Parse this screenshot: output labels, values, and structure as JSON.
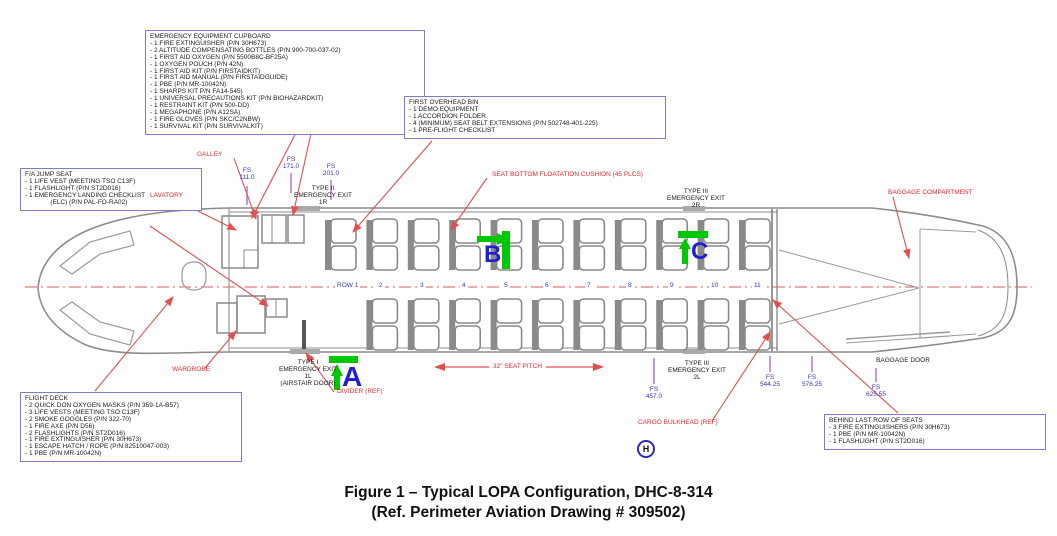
{
  "figure": {
    "caption_line1": "Figure 1 – Typical LOPA Configuration, DHC-8-314",
    "caption_line2": "(Ref. Perimeter Aviation Drawing # 309502)"
  },
  "callout_boxes": {
    "emergency_equipment_cupboard": {
      "title": "EMERGENCY EQUIPMENT CUPBOARD",
      "items": [
        "- 1 FIRE EXTINGUISHER (P/N 30H673)",
        "- 2 ALTITUDE COMPENSATING BOTTLES (P/N 900-700-037-02)",
        "- 1 FIRST AID OXYGEN (P/N 5500B8C-BF25A)",
        "- 1 OXYGEN POUCH (P/N 42N)",
        "- 1 FIRST AID KIT (P/N FIRSTAIDKIT)",
        "- 1 FIRST AID MANUAL (P/N FIRSTAIDGUIDE)",
        "- 1 PBE (P/N MR-10042N)",
        "- 1 SHARPS KIT P/N FA14-545)",
        "- 1 UNIVERSAL PRECAUTIONS KIT (P/N BIOHAZARDKIT)",
        "- 1 RESTRAINT KIT (P/N 500-DD)",
        "- 1 MEGAPHONE (P/N A12SA)",
        "- 1 FIRE GLOVES (P/N SKC/C2NBW)",
        "- 1 SURVIVAL KIT (P/N SURVIVALKIT)"
      ]
    },
    "fa_jump_seat": {
      "title": "F/A JUMP SEAT",
      "items": [
        "- 1 LIFE VEST (MEETING TSO C13F)",
        "- 1 FLASHLIGHT (P/N ST2D016)",
        "- 1 EMERGENCY LANDING CHECKLIST",
        "              (ELC) (P/N PAL-FO-RA02)"
      ]
    },
    "first_overhead_bin": {
      "title": "FIRST OVERHEAD BIN",
      "items": [
        "- 1 DEMO EQUIPMENT",
        "- 1 ACCORDION FOLDER",
        "- 4 (MINIMUM) SEAT BELT EXTENSIONS (P/N 502748-401-225)",
        "- 1 PRE-FLIGHT CHECKLIST"
      ]
    },
    "flight_deck": {
      "title": "FLIGHT DECK",
      "items": [
        "- 2 QUICK DON OXYGEN MASKS (P/N 359-1A-B57)",
        "- 3 LIFE VESTS (MEETING TSO C13F)",
        "- 2 SMOKE GOGGLES (P/N 322-70)",
        "- 1 FIRE AXE (P/N D56)",
        "- 2 FLASHLIGHTS (P/N ST2D016)",
        "- 1 FIRE EXTINGUISHER (P/N 30H673)",
        "- 1 ESCAPE HATCH / ROPE (P/N 82510047-003)",
        "- 1 PBE (P/N MR-10042N)"
      ]
    },
    "behind_last_row": {
      "title": "BEHIND LAST ROW OF SEATS",
      "items": [
        "- 3 FIRE EXTINGUISHERS (P/N 30H673)",
        "- 1 PBE (P/N MR-10042N)",
        "- 1 FLASHLIGHT (P/N ST2D016)"
      ]
    }
  },
  "red_labels": {
    "galley": "GALLEY",
    "lavatory": "LAVATORY",
    "seat_cushion": "SEAT BOTTOM FLOATATION CUSHION (45 PLCS)",
    "baggage_compartment": "BAGGAGE COMPARTMENT",
    "wardrobe": "WARDROBE",
    "divider_ref": "DIVIDER (REF)",
    "cargo_bulkhead_ref": "CARGO BULKHEAD (REF)",
    "seat_pitch": "32\" SEAT PITCH"
  },
  "black_labels": {
    "type2_exit_1r": [
      "TYPE II",
      "EMERGENCY EXIT",
      "1R"
    ],
    "type3_exit_2r": [
      "TYPE III",
      "EMERGENCY EXIT",
      "2R"
    ],
    "type1_exit_1l": [
      "TYPE I",
      "EMERGENCY EXIT",
      "1L",
      "(AIRSTAIR DOOR)"
    ],
    "type3_exit_2l": [
      "TYPE III",
      "EMERGENCY EXIT",
      "2L"
    ],
    "baggage_door": "BAGGAGE DOOR"
  },
  "fs_stations": [
    {
      "label": "FS",
      "value": "111.0"
    },
    {
      "label": "FS",
      "value": "171.0"
    },
    {
      "label": "FS",
      "value": "201.0"
    },
    {
      "label": "FS",
      "value": "457.0"
    },
    {
      "label": "FS",
      "value": "544.25"
    },
    {
      "label": "FS",
      "value": "576.25"
    },
    {
      "label": "FS",
      "value": "625.55"
    }
  ],
  "row_markers": [
    "ROW 1",
    "2",
    "3",
    "4",
    "5",
    "6",
    "7",
    "8",
    "9",
    "10",
    "11"
  ],
  "seat_markers": {
    "a": "A",
    "b": "B",
    "c": "C"
  },
  "hatch_marker": "H",
  "colors": {
    "callout_border": "#7b7bd0",
    "label_red": "#e8252c",
    "leader_red": "#e05050",
    "station_blue": "#3434cf",
    "tick_purple": "#b06cc8",
    "marker_green": "#00c800",
    "marker_blue": "#1f1fd6",
    "hull_gray": "#8c8c8c"
  }
}
